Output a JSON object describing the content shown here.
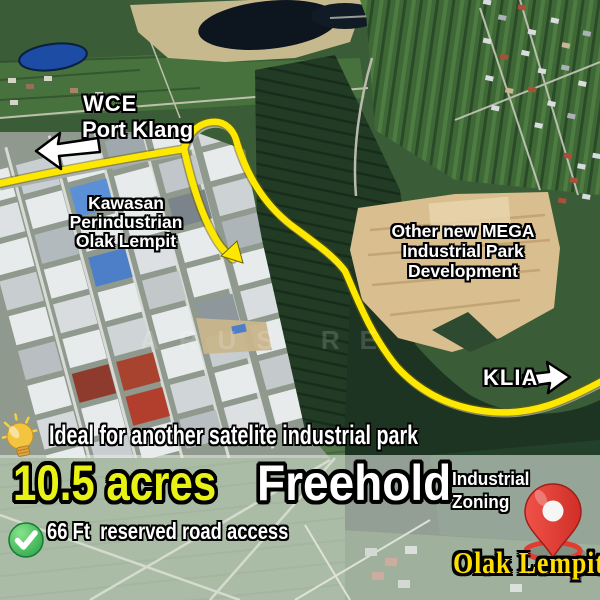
{
  "map": {
    "labels": {
      "wce": "WCE",
      "port_klang": "Port Klang",
      "kawasan": [
        "Kawasan",
        "Perindustrian",
        "Olak Lempit"
      ],
      "mega": [
        "Other new MEGA",
        "Industrial Park",
        "Development"
      ],
      "klia": "KLIA",
      "watermark": "ARUS  RE"
    },
    "icons": {
      "arrow_left": "arrow-left",
      "arrow_right": "arrow-right",
      "route_end": "arrow-down-right",
      "pin": "map-pin",
      "bulb": "lightbulb",
      "check": "check-circle"
    },
    "route_color": "#FFE800"
  },
  "banner": {
    "tagline": "Ideal for another satelite industrial park",
    "area": "10.5 acres",
    "tenure": "Freehold",
    "zoning": [
      "Industrial",
      "Zoning"
    ],
    "road_access": "66 Ft  reserved road access",
    "location": "Olak Lempit"
  },
  "colors": {
    "route": "#FFE800",
    "area_text": "#E9F215",
    "location_text": "#FFDE00",
    "pin_red": "#E23B31",
    "check_green": "#2DA44C"
  }
}
